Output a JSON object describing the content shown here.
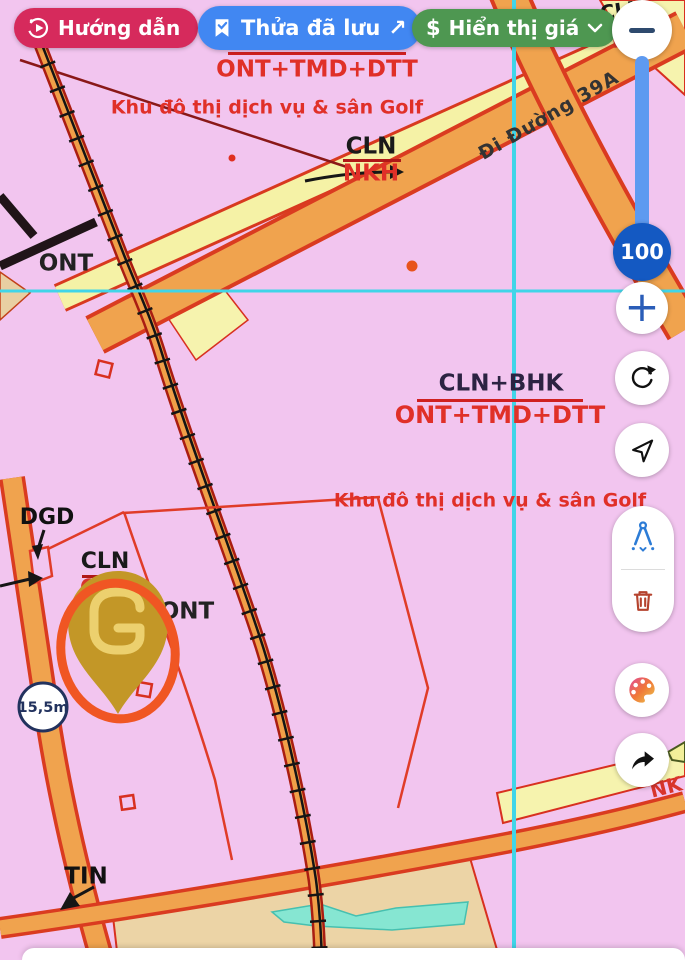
{
  "header": {
    "guide": {
      "label": "Hướng dẫn"
    },
    "saved": {
      "label": "Thửa đã lưu",
      "arrow": "↗"
    },
    "price": {
      "currency": "$",
      "label": "Hiển thị giá"
    }
  },
  "zoom_controls": {
    "level": "100",
    "minus": "−",
    "plus": "+"
  },
  "map": {
    "fraction_top": {
      "denominator": "ONT+TMD+DTT"
    },
    "golf_top": "Khu đô thị dịch vụ & sân Golf",
    "cln_nkh": {
      "numerator": "CLN",
      "denominator": "NKH"
    },
    "road_name": "Đi Đường 39A",
    "ont_left": "ONT",
    "fraction_mid": {
      "numerator": "CLN+BHK",
      "denominator": "ONT+TMD+DTT"
    },
    "golf_mid": "Khu đô thị dịch vụ & sân Golf",
    "dgd": "DGD",
    "cln_ont": {
      "numerator": "CLN",
      "denominator": "ONT"
    },
    "ont_pin": "ONT",
    "tin": "TIN",
    "width_marker": "15,5m",
    "nk_right": "NK",
    "cln_corner": "CLN",
    "n_corner": "N"
  },
  "colors": {
    "guide_bg": "#d62a5c",
    "saved_bg": "#4187f2",
    "price_bg": "#4e9751",
    "zoom_badge": "#1459c2",
    "annotation_circle": "#f05623",
    "crosshair": "#40d5e8",
    "road_fill": "#f0a34e",
    "road_casing": "#da3b20",
    "map_bg": "#f2c5ef",
    "pin_gold": "#c39727"
  }
}
